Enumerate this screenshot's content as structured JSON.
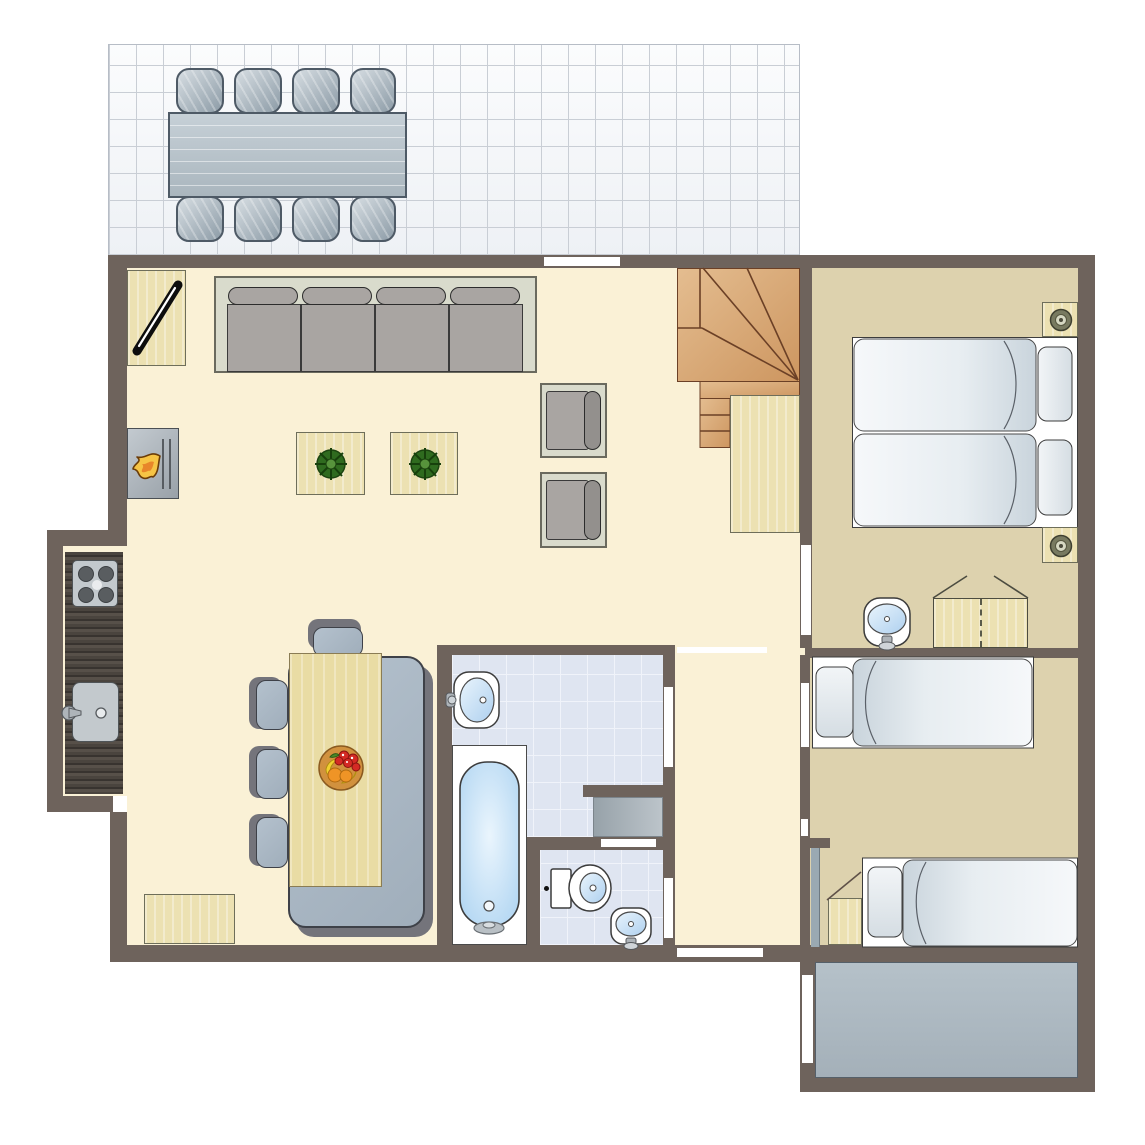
{
  "meta": {
    "title": "Holiday home ground-floor plan",
    "canvas": {
      "width": 1145,
      "height": 1145
    },
    "style": "top-down architectural floor plan, no text labels"
  },
  "colors": {
    "outside": "#ffffff",
    "wall": "#6e635c",
    "floor_cream": "#faf1d6",
    "floor_tan": "#ddd2ae",
    "terrace_tile": "#eef1f5",
    "terrace_tile_line": "#c9ced5",
    "bath_tile": "#dfe5f1",
    "bath_tile_line": "#f0f3fa",
    "terrace2_floor": "#a4b0b9",
    "wood_stair": "#d7a97b",
    "wood_stair_line": "#6b4026",
    "wood_pale": "#ece1b2",
    "wood_pale_border": "#6e6e5a",
    "wood_table": "#e9dca4",
    "seat_gray": "#a0aebb",
    "seat_border": "#3e4148",
    "seat_shadow": "#74747b",
    "sofa_frame": "#d9dbcc",
    "sofa_frame_border": "#6a6a5e",
    "cushion": "#a9a5a2",
    "cushion_border": "#3a3a3a",
    "appliance": "#c3c9cd",
    "fixture_border": "#3c3c3c",
    "basin_blue": "#aed0ef",
    "mattress_light": "#f6f8fa",
    "mattress_dark": "#c9d4dc",
    "outdoor_table": "#aab6be",
    "outdoor_border": "#4e5a66",
    "outdoor_chair_light": "#d6dde2",
    "outdoor_chair_dark": "#8d9ca7",
    "flame_yellow": "#f6c445",
    "flame_orange": "#e8862a",
    "plant_dark": "#2f6b1f",
    "plant_light": "#57933c",
    "door_leaf": "#9aa9b2"
  },
  "rooms": [
    {
      "id": "terrace-top",
      "name": "terrace with outdoor dining set",
      "floor": "light tiles"
    },
    {
      "id": "living-room",
      "name": "living room",
      "floor": "cream"
    },
    {
      "id": "kitchen",
      "name": "kitchen nook",
      "floor": "cream"
    },
    {
      "id": "dining-area",
      "name": "dining area",
      "floor": "cream"
    },
    {
      "id": "staircase",
      "name": "winder staircase",
      "floor": "wood"
    },
    {
      "id": "bedroom-1",
      "name": "bedroom with two single beds pushed together",
      "floor": "tan"
    },
    {
      "id": "bathroom",
      "name": "bathroom with bathtub and washbasin",
      "floor": "blue tiles"
    },
    {
      "id": "toilet-room",
      "name": "separate toilet room",
      "floor": "blue tiles"
    },
    {
      "id": "hallway",
      "name": "hallway",
      "floor": "cream"
    },
    {
      "id": "bedroom-2",
      "name": "bedroom with two single beds",
      "floor": "tan"
    },
    {
      "id": "terrace-bottom",
      "name": "small rear terrace",
      "floor": "grey stone"
    }
  ],
  "furniture_inventory": {
    "outdoor_dining_table": 1,
    "outdoor_chairs": 8,
    "sofa_seats": 4,
    "armchairs": 2,
    "coffee_tables_with_plant": 2,
    "tv_cabinet": 1,
    "fireplace": 1,
    "stove_burners": 4,
    "kitchen_sink": 1,
    "dining_table": 1,
    "dining_bench": 1,
    "dining_chairs": 4,
    "fruit_bowl": 1,
    "rug": 1,
    "understairs_cabinet": 1,
    "single_beds": 4,
    "nightstands_with_lamp": 2,
    "nightstand_plain": 1,
    "wardrobe": 1,
    "washbasins": 4,
    "bathtub": 1,
    "toilet": 1,
    "washing_machine": 1,
    "door_openings": 10
  }
}
